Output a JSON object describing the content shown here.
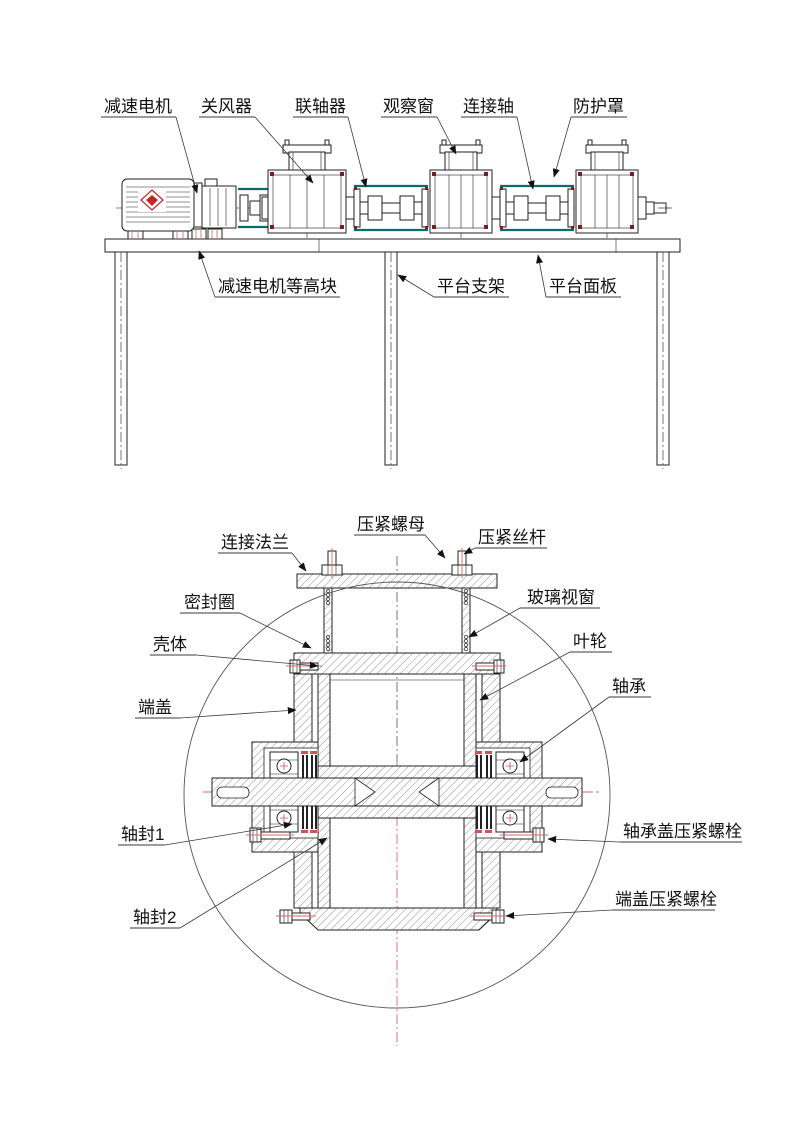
{
  "drawing": {
    "assembly_view": {
      "labels": {
        "gear_motor": "减速电机",
        "rotary_airlock": "关风器",
        "coupling": "联轴器",
        "observation_window": "观察窗",
        "connecting_shaft": "连接轴",
        "protective_guard": "防护罩",
        "motor_riser_block": "减速电机等高块",
        "platform_support": "平台支架",
        "platform_panel": "平台面板"
      }
    },
    "section_view": {
      "labels": {
        "connecting_flange": "连接法兰",
        "compression_nut": "压紧螺母",
        "compression_screw": "压紧丝杆",
        "seal_ring": "密封圈",
        "glass_window": "玻璃视窗",
        "shell": "壳体",
        "impeller": "叶轮",
        "end_cover": "端盖",
        "bearing": "轴承",
        "shaft_seal_1": "轴封1",
        "shaft_seal_2": "轴封2",
        "bearing_cover_bolt": "轴承盖压紧螺栓",
        "end_cover_bolt": "端盖压紧螺栓"
      }
    },
    "colors": {
      "line": "#222222",
      "centerline_red": "#d66a6a",
      "guard_teal": "#0e6b6b",
      "bolt_red": "#7a1d1d"
    }
  }
}
